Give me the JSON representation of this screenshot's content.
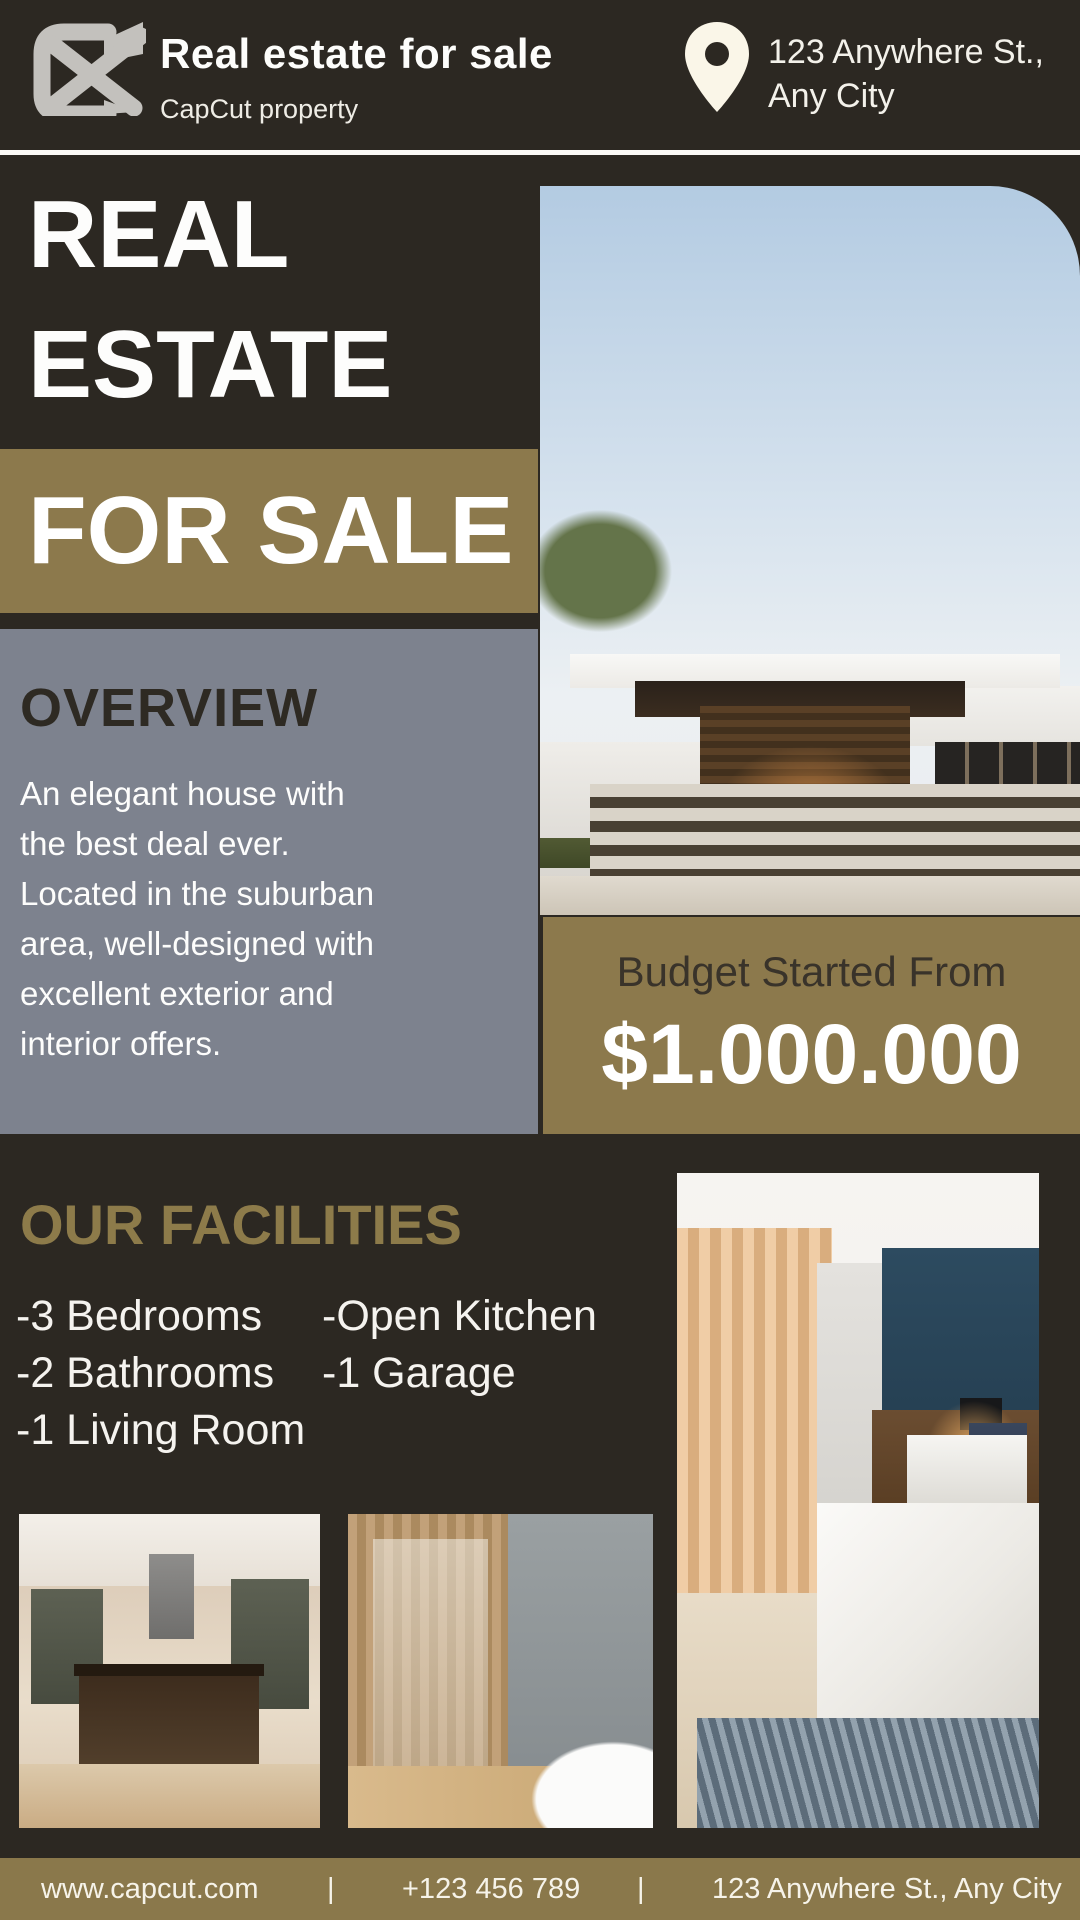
{
  "brand": {
    "title": "Real estate for sale",
    "subtitle": "CapCut property"
  },
  "header": {
    "address": "123 Anywhere St.,\nAny City"
  },
  "hero": {
    "title": "REAL\nESTATE",
    "badge": "FOR SALE"
  },
  "overview": {
    "heading": "OVERVIEW",
    "body": "An elegant house with\nthe best deal ever.\nLocated in the suburban\narea, well-designed with\nexcellent exterior and\ninterior offers."
  },
  "budget": {
    "label": "Budget Started From",
    "price": "$1.000.000"
  },
  "facilities": {
    "heading": "OUR FACILITIES",
    "column1": [
      "-3 Bedrooms",
      "-2 Bathrooms",
      "-1 Living Room"
    ],
    "column2": [
      "-Open Kitchen",
      "-1 Garage"
    ]
  },
  "photos": {
    "hero": "modern-house-exterior",
    "kitchen": "kitchen-interior",
    "bathroom": "bathroom-interior",
    "bedroom": "bedroom-interior"
  },
  "footer": {
    "website": "www.capcut.com",
    "separator": "|",
    "phone": "+123 456 789",
    "address": "123 Anywhere St., Any City"
  },
  "colors": {
    "background": "#2c2822",
    "olive": "#8c794c",
    "gold_text": "#8d7b4a",
    "panel_gray": "#7d828e",
    "cream": "#faf6e8",
    "white": "#ffffff",
    "dark_text": "#2e2a23"
  }
}
